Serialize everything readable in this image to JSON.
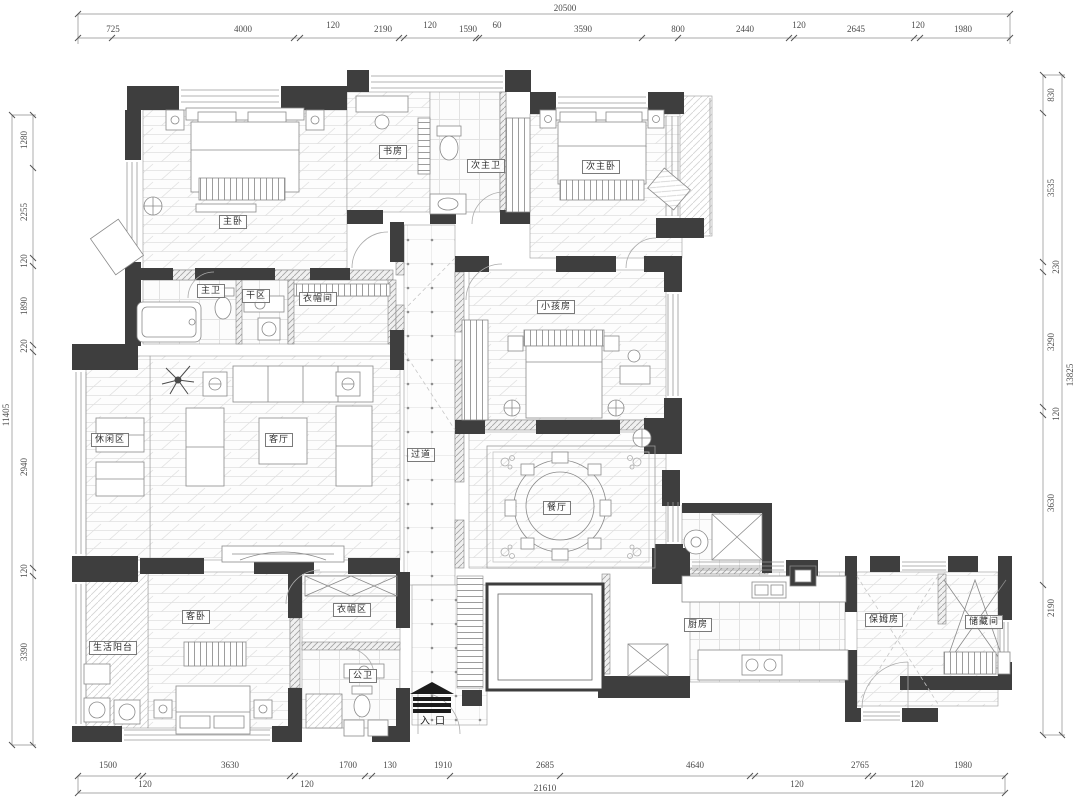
{
  "rooms": {
    "master_bedroom": "主卧",
    "study": "书房",
    "second_master_bath": "次主卫",
    "second_master_bedroom": "次主卧",
    "master_bath": "主卫",
    "dry_area": "干区",
    "walk_in_closet": "衣帽间",
    "kids_room": "小孩房",
    "leisure_area": "休闲区",
    "living_room": "客厅",
    "corridor": "过道",
    "dining_room": "餐厅",
    "guest_bedroom": "客卧",
    "utility_balcony": "生活阳台",
    "closet_area": "衣帽区",
    "guest_bath": "公卫",
    "kitchen": "厨房",
    "nanny_room": "保姆房",
    "storage": "储藏间",
    "entrance": "入口"
  },
  "dimensions": {
    "top": {
      "overall": "20500",
      "segments": [
        "725",
        "4000",
        "120",
        "2190",
        "120",
        "1590",
        "60",
        "3590",
        "800",
        "2440",
        "120",
        "2645",
        "120",
        "1980"
      ]
    },
    "bottom": {
      "overall": "21610",
      "segments": [
        "1500",
        "3630",
        "1700",
        "130",
        "1910",
        "2685",
        "4640",
        "2765",
        "1980"
      ],
      "between": [
        "120",
        "120",
        "120",
        "120"
      ]
    },
    "left": {
      "overall": "11405",
      "segments": [
        "1280",
        "2255",
        "120",
        "1890",
        "220",
        "2940",
        "120",
        "3390"
      ]
    },
    "right": {
      "overall": "13825",
      "segments": [
        "830",
        "3535",
        "230",
        "3290",
        "120",
        "3630",
        "2190"
      ]
    }
  },
  "colors": {
    "wall": "#3e3e3e",
    "line": "#8a8a8a",
    "dim_text": "#4a4a4a",
    "paper": "#ffffff"
  },
  "icons": {
    "entrance_marker": "entrance-arrow-icon"
  }
}
